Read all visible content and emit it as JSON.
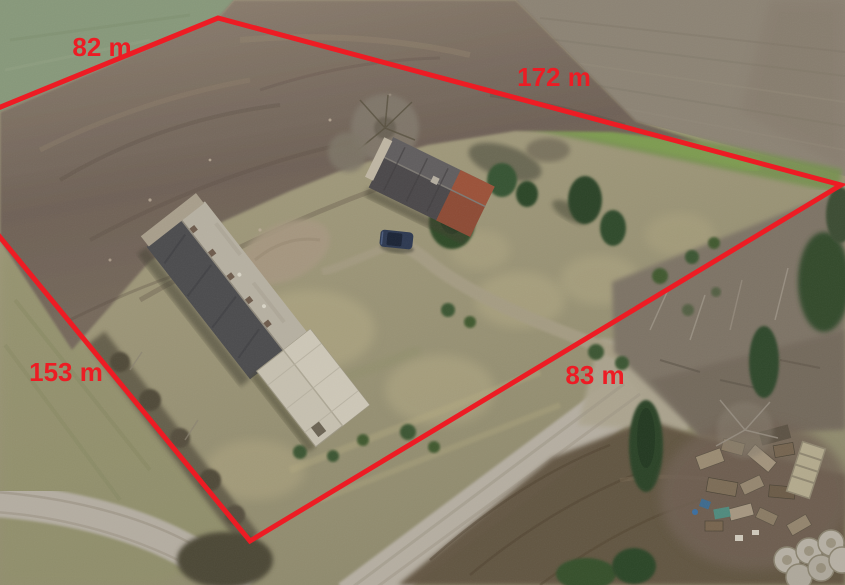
{
  "photo": {
    "type": "aerial-drone-photograph",
    "scene": "Rural homestead parcel outlined in red: plowed field, long barn with slate roof, farmhouse with red brick gable, gravel roads, conifer and bare trees, pallet debris pile and concrete rings",
    "objects": {
      "barn": "long outbuilding, dark slate + light metal roof",
      "farmhouse": "house with dark roof and red brick end",
      "car": "dark SUV parked on driveway",
      "debris": "stacked wooden pallets and scrap",
      "rings": "light concrete rings in bottom-right corner"
    },
    "palette": {
      "pasture_green": "#87987a",
      "plowed_field_brown": "#6e6156",
      "dry_grass": "#a49c7e",
      "gravel_road": "#b5aea1",
      "conifer_green": "#2d4827",
      "slate_roof": "#4b4b4d",
      "brick_red": "#9b5138"
    }
  },
  "annotation": {
    "color": "#ed1c24",
    "line_width": 5,
    "boundary_points": "-80,140 218,18 841,185 250,541",
    "labels": [
      {
        "text": "82 m",
        "x": 102,
        "y": 56
      },
      {
        "text": "172 m",
        "x": 554,
        "y": 86
      },
      {
        "text": "153 m",
        "x": 66,
        "y": 381
      },
      {
        "text": "83 m",
        "x": 595,
        "y": 384
      }
    ]
  }
}
